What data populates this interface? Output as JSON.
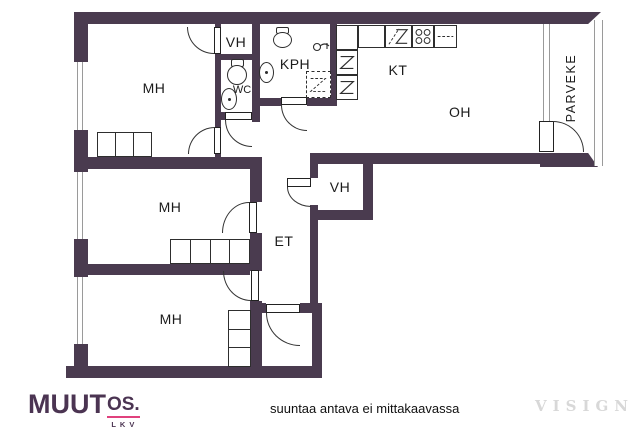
{
  "rooms": {
    "mh_top": {
      "label": "MH"
    },
    "mh_middle": {
      "label": "MH"
    },
    "mh_bottom": {
      "label": "MH"
    },
    "vh_top": {
      "label": "VH"
    },
    "vh_middle": {
      "label": "VH"
    },
    "wc": {
      "label": "WC"
    },
    "kph": {
      "label": "KPH"
    },
    "kt": {
      "label": "KT"
    },
    "oh": {
      "label": "OH"
    },
    "et": {
      "label": "ET"
    },
    "parveke": {
      "label": "PARVEKE"
    }
  },
  "footer": {
    "logo": {
      "main": "MUUT",
      "suffix": "OS.",
      "sub": "LKV"
    },
    "disclaimer": "suuntaa antava ei mittakaavassa",
    "watermark": "VISIGN"
  },
  "colors": {
    "wall": "#4a3b4f",
    "logo_purple": "#4b3452",
    "logo_pink": "#e0417d",
    "fixture_line": "#2e2e2e",
    "window_line": "#9a9a9a",
    "label_text": "#1b1b1b",
    "watermark_gray": "#d8d8d8"
  }
}
